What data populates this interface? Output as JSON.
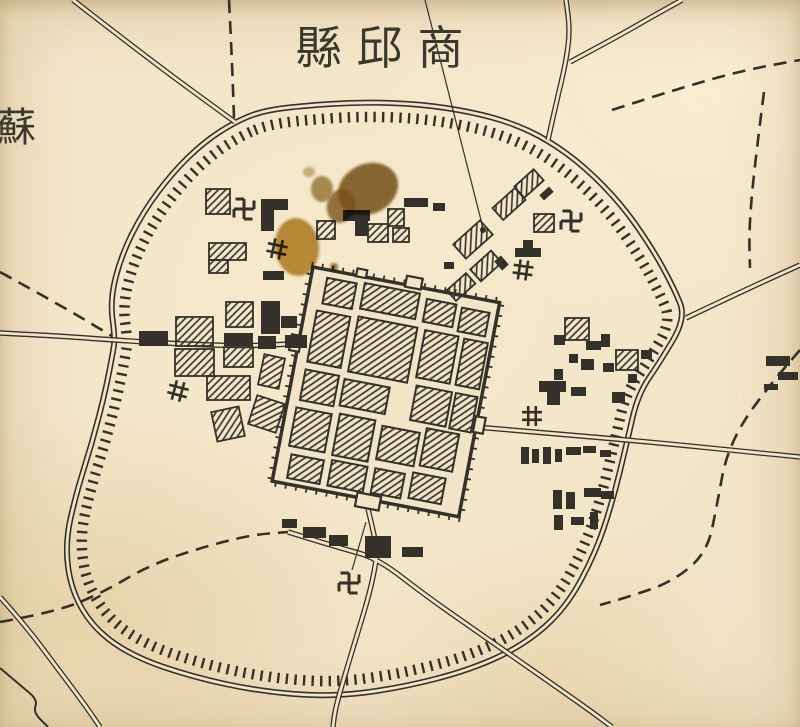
{
  "title": {
    "display": "縣邱商",
    "reading": "商邱縣 (Shangqiu County), written right-to-left"
  },
  "edge_label": {
    "display": "蘇"
  },
  "palette": {
    "paper": "#f2e4c6",
    "ink": "#33312a",
    "hatch": "#3b382f",
    "stain_dark": "#7a571c",
    "stain_mid": "#8a6a22",
    "stain_light": "#b08324"
  },
  "map": {
    "ring": {
      "points": [
        [
          235,
          122
        ],
        [
          262,
          111
        ],
        [
          300,
          106
        ],
        [
          360,
          102
        ],
        [
          420,
          104
        ],
        [
          472,
          112
        ],
        [
          512,
          123
        ],
        [
          548,
          140
        ],
        [
          585,
          167
        ],
        [
          622,
          205
        ],
        [
          652,
          248
        ],
        [
          674,
          288
        ],
        [
          686,
          318
        ],
        [
          660,
          362
        ],
        [
          638,
          394
        ],
        [
          627,
          442
        ],
        [
          613,
          500
        ],
        [
          596,
          552
        ],
        [
          566,
          608
        ],
        [
          524,
          645
        ],
        [
          470,
          670
        ],
        [
          400,
          688
        ],
        [
          330,
          697
        ],
        [
          258,
          691
        ],
        [
          193,
          677
        ],
        [
          134,
          657
        ],
        [
          94,
          629
        ],
        [
          71,
          590
        ],
        [
          65,
          543
        ],
        [
          76,
          494
        ],
        [
          92,
          443
        ],
        [
          105,
          393
        ],
        [
          113,
          352
        ],
        [
          115,
          338
        ],
        [
          110,
          300
        ],
        [
          121,
          256
        ],
        [
          143,
          212
        ],
        [
          173,
          172
        ],
        [
          204,
          142
        ]
      ],
      "center": [
        377,
        400
      ],
      "hachure_scale": 0.952
    },
    "roads": [
      {
        "style": "double",
        "points": [
          [
            73,
            0
          ],
          [
            150,
            60
          ],
          [
            235,
            122
          ]
        ]
      },
      {
        "style": "dashed",
        "points": [
          [
            229,
            0
          ],
          [
            232,
            60
          ],
          [
            234,
            118
          ]
        ]
      },
      {
        "style": "double",
        "points": [
          [
            548,
            140
          ],
          [
            556,
            104
          ],
          [
            566,
            62
          ],
          [
            570,
            30
          ],
          [
            566,
            0
          ]
        ]
      },
      {
        "style": "double",
        "points": [
          [
            570,
            62
          ],
          [
            615,
            38
          ],
          [
            655,
            15
          ],
          [
            682,
            0
          ]
        ]
      },
      {
        "style": "dashed",
        "points": [
          [
            612,
            110
          ],
          [
            680,
            88
          ],
          [
            745,
            70
          ],
          [
            800,
            60
          ]
        ]
      },
      {
        "style": "dashed",
        "points": [
          [
            764,
            92
          ],
          [
            754,
            170
          ],
          [
            749,
            230
          ],
          [
            750,
            268
          ]
        ]
      },
      {
        "style": "double",
        "points": [
          [
            686,
            318
          ],
          [
            745,
            290
          ],
          [
            800,
            265
          ]
        ]
      },
      {
        "style": "double",
        "points": [
          [
            0,
            333
          ],
          [
            60,
            336
          ],
          [
            113,
            340
          ],
          [
            180,
            344
          ],
          [
            245,
            346
          ],
          [
            291,
            344
          ]
        ]
      },
      {
        "style": "dashed",
        "points": [
          [
            0,
            272
          ],
          [
            60,
            305
          ],
          [
            112,
            336
          ]
        ]
      },
      {
        "style": "double",
        "points": [
          [
            476,
            427
          ],
          [
            560,
            434
          ],
          [
            660,
            443
          ],
          [
            740,
            451
          ],
          [
            800,
            457
          ]
        ]
      },
      {
        "style": "dashed",
        "points": [
          [
            800,
            350
          ],
          [
            758,
            398
          ],
          [
            727,
            450
          ],
          [
            717,
            505
          ],
          [
            707,
            553
          ],
          [
            672,
            582
          ],
          [
            628,
            597
          ],
          [
            600,
            605
          ]
        ]
      },
      {
        "style": "double",
        "points": [
          [
            368,
            509
          ],
          [
            376,
            542
          ],
          [
            377,
            557
          ],
          [
            370,
            592
          ],
          [
            357,
            635
          ],
          [
            344,
            678
          ],
          [
            335,
            710
          ],
          [
            333,
            727
          ]
        ]
      },
      {
        "style": "double",
        "points": [
          [
            288,
            532
          ],
          [
            340,
            548
          ],
          [
            377,
            558
          ],
          [
            425,
            595
          ],
          [
            472,
            628
          ],
          [
            515,
            658
          ],
          [
            558,
            688
          ],
          [
            592,
            712
          ],
          [
            612,
            727
          ]
        ]
      },
      {
        "style": "dashed",
        "points": [
          [
            0,
            622
          ],
          [
            55,
            612
          ],
          [
            100,
            594
          ],
          [
            150,
            565
          ],
          [
            200,
            548
          ],
          [
            250,
            535
          ],
          [
            288,
            532
          ]
        ]
      },
      {
        "style": "double",
        "points": [
          [
            0,
            597
          ],
          [
            25,
            625
          ],
          [
            55,
            665
          ],
          [
            85,
            705
          ],
          [
            100,
            727
          ]
        ]
      },
      {
        "style": "single",
        "points": [
          [
            0,
            668
          ],
          [
            20,
            685
          ],
          [
            38,
            700
          ],
          [
            33,
            712
          ],
          [
            48,
            727
          ]
        ]
      }
    ],
    "city": {
      "origin": [
        313,
        267
      ],
      "rotation": 10.8,
      "width": 190,
      "height": 218,
      "gates": [
        [
          94,
          -9,
          16,
          11
        ],
        [
          44,
          -7,
          10,
          8
        ],
        [
          -8,
          70,
          10,
          16
        ],
        [
          188,
          116,
          10,
          16
        ],
        [
          86,
          213,
          24,
          14
        ]
      ],
      "blocks": [
        [
          16,
          8,
          30,
          26
        ],
        [
          54,
          6,
          56,
          26
        ],
        [
          118,
          10,
          30,
          23
        ],
        [
          154,
          12,
          28,
          24
        ],
        [
          12,
          42,
          34,
          52
        ],
        [
          54,
          40,
          60,
          56
        ],
        [
          122,
          41,
          34,
          48
        ],
        [
          162,
          42,
          24,
          47
        ],
        [
          12,
          102,
          34,
          31
        ],
        [
          52,
          104,
          46,
          27
        ],
        [
          124,
          97,
          36,
          35
        ],
        [
          164,
          97,
          22,
          36
        ],
        [
          10,
          141,
          36,
          39
        ],
        [
          54,
          139,
          36,
          42
        ],
        [
          98,
          143,
          38,
          34
        ],
        [
          142,
          137,
          33,
          38
        ],
        [
          14,
          188,
          33,
          24
        ],
        [
          55,
          186,
          36,
          26
        ],
        [
          99,
          186,
          30,
          25
        ],
        [
          137,
          183,
          33,
          26
        ]
      ]
    },
    "building_format": "[kind solid|hatched, x, y, w, h, rotation_deg]",
    "buildings": [
      [
        "h",
        206,
        189,
        24,
        25,
        0
      ],
      [
        "s",
        261,
        199,
        27,
        11,
        0
      ],
      [
        "s",
        261,
        210,
        13,
        21,
        0
      ],
      [
        "h",
        209,
        243,
        37,
        17,
        0
      ],
      [
        "h",
        209,
        260,
        19,
        13,
        0
      ],
      [
        "s",
        263,
        271,
        21,
        9,
        0
      ],
      [
        "s",
        343,
        210,
        27,
        11,
        0
      ],
      [
        "s",
        355,
        221,
        13,
        15,
        0
      ],
      [
        "h",
        317,
        221,
        18,
        18,
        0
      ],
      [
        "h",
        368,
        224,
        20,
        18,
        0
      ],
      [
        "h",
        388,
        209,
        16,
        17,
        0
      ],
      [
        "s",
        404,
        198,
        24,
        9,
        0
      ],
      [
        "s",
        433,
        203,
        12,
        8,
        0
      ],
      [
        "h",
        393,
        228,
        16,
        14,
        0
      ],
      [
        "h",
        516,
        176,
        26,
        15,
        -42
      ],
      [
        "h",
        494,
        196,
        30,
        16,
        -42
      ],
      [
        "h",
        534,
        214,
        20,
        18,
        0
      ],
      [
        "h",
        455,
        230,
        36,
        19,
        -42
      ],
      [
        "h",
        472,
        258,
        28,
        16,
        -42
      ],
      [
        "h",
        448,
        280,
        26,
        14,
        -42
      ],
      [
        "s",
        540,
        190,
        13,
        7,
        -42
      ],
      [
        "s",
        515,
        248,
        26,
        9,
        0
      ],
      [
        "s",
        523,
        240,
        10,
        8,
        0
      ],
      [
        "s",
        497,
        257,
        9,
        12,
        -42
      ],
      [
        "s",
        444,
        262,
        10,
        7,
        0
      ],
      [
        "h",
        176,
        317,
        37,
        29,
        0
      ],
      [
        "h",
        175,
        349,
        39,
        27,
        0
      ],
      [
        "h",
        226,
        302,
        27,
        25,
        0
      ],
      [
        "h",
        224,
        347,
        29,
        20,
        0
      ],
      [
        "h",
        207,
        376,
        43,
        24,
        0
      ],
      [
        "h",
        261,
        356,
        21,
        31,
        12
      ],
      [
        "h",
        252,
        399,
        29,
        30,
        18
      ],
      [
        "h",
        214,
        409,
        28,
        30,
        -12
      ],
      [
        "s",
        139,
        331,
        29,
        15,
        0
      ],
      [
        "s",
        261,
        301,
        19,
        33,
        0
      ],
      [
        "s",
        281,
        316,
        16,
        12,
        0
      ],
      [
        "s",
        224,
        333,
        29,
        13,
        0
      ],
      [
        "s",
        258,
        336,
        18,
        13,
        0
      ],
      [
        "s",
        285,
        335,
        22,
        13,
        0
      ],
      [
        "h",
        565,
        318,
        24,
        22,
        0
      ],
      [
        "h",
        616,
        350,
        22,
        20,
        0
      ],
      [
        "s",
        554,
        335,
        11,
        10,
        0
      ],
      [
        "s",
        586,
        341,
        15,
        9,
        0
      ],
      [
        "s",
        601,
        334,
        9,
        13,
        0
      ],
      [
        "s",
        569,
        354,
        9,
        9,
        0
      ],
      [
        "s",
        581,
        359,
        13,
        11,
        0
      ],
      [
        "s",
        603,
        363,
        11,
        9,
        0
      ],
      [
        "s",
        554,
        369,
        9,
        11,
        0
      ],
      [
        "s",
        539,
        381,
        27,
        11,
        0
      ],
      [
        "s",
        547,
        392,
        13,
        13,
        0
      ],
      [
        "s",
        571,
        387,
        15,
        9,
        0
      ],
      [
        "s",
        612,
        392,
        13,
        11,
        0
      ],
      [
        "s",
        628,
        374,
        9,
        9,
        0
      ],
      [
        "s",
        641,
        350,
        11,
        9,
        0
      ],
      [
        "s",
        521,
        447,
        8,
        17,
        0
      ],
      [
        "s",
        532,
        449,
        7,
        14,
        0
      ],
      [
        "s",
        543,
        447,
        8,
        17,
        0
      ],
      [
        "s",
        555,
        449,
        7,
        13,
        0
      ],
      [
        "s",
        566,
        447,
        15,
        8,
        0
      ],
      [
        "s",
        583,
        446,
        13,
        7,
        0
      ],
      [
        "s",
        600,
        450,
        11,
        7,
        0
      ],
      [
        "s",
        553,
        490,
        9,
        19,
        0
      ],
      [
        "s",
        566,
        492,
        9,
        17,
        0
      ],
      [
        "s",
        584,
        488,
        17,
        9,
        0
      ],
      [
        "s",
        601,
        491,
        13,
        8,
        0
      ],
      [
        "s",
        554,
        515,
        9,
        15,
        0
      ],
      [
        "s",
        571,
        517,
        13,
        8,
        0
      ],
      [
        "s",
        590,
        512,
        8,
        17,
        0
      ],
      [
        "s",
        282,
        519,
        15,
        9,
        0
      ],
      [
        "s",
        303,
        527,
        23,
        11,
        0
      ],
      [
        "s",
        329,
        535,
        19,
        11,
        0
      ],
      [
        "s",
        365,
        536,
        26,
        22,
        0
      ],
      [
        "s",
        402,
        547,
        21,
        10,
        0
      ],
      [
        "s",
        766,
        356,
        24,
        10,
        0
      ],
      [
        "s",
        778,
        372,
        20,
        8,
        0
      ],
      [
        "s",
        764,
        384,
        14,
        6,
        0
      ]
    ],
    "symbols": {
      "swastika_glyph": "卍",
      "well_glyph": "井",
      "swastikas": [
        [
          244,
          209,
          0
        ],
        [
          571,
          221,
          0
        ],
        [
          349,
          583,
          0
        ]
      ],
      "wells": [
        [
          277,
          249,
          12
        ],
        [
          178,
          391,
          15
        ],
        [
          523,
          270,
          8
        ],
        [
          532,
          416,
          0
        ]
      ]
    },
    "leaders": [
      [
        [
          425,
          0
        ],
        [
          483,
          228
        ]
      ],
      [
        [
          352,
          570
        ],
        [
          366,
          522
        ]
      ]
    ],
    "leader_dot": [
      483,
      230
    ],
    "stain_format": "[cx, cy, rx, ry, rotation, color, opacity]",
    "stains": [
      [
        368,
        189,
        31,
        25,
        -25,
        "#7a571c",
        0.85
      ],
      [
        341,
        206,
        14,
        17,
        15,
        "#7a571c",
        0.78
      ],
      [
        322,
        189,
        11,
        13,
        0,
        "#8a6a22",
        0.7
      ],
      [
        309,
        172,
        6,
        5,
        0,
        "#9a7a2e",
        0.5
      ],
      [
        297,
        247,
        22,
        29,
        -6,
        "#b08324",
        0.85
      ],
      [
        334,
        267,
        4,
        4,
        0,
        "#7a571c",
        0.8
      ]
    ]
  }
}
